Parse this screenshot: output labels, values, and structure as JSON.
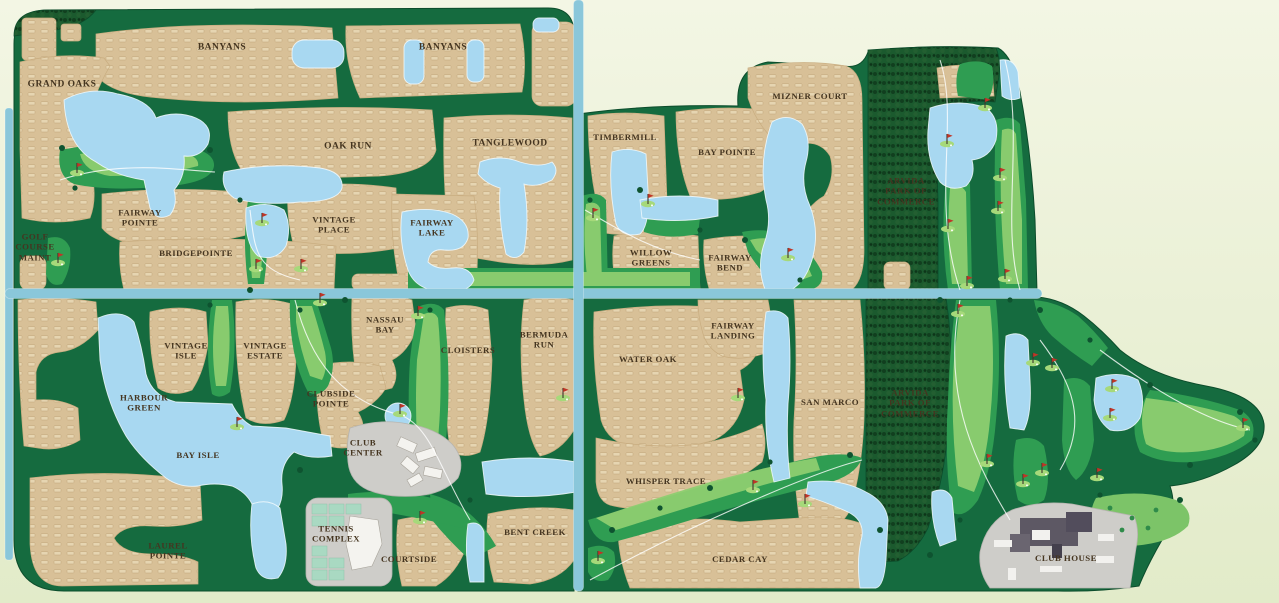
{
  "map": {
    "type": "residential-golf-community-site-map",
    "colors": {
      "background_top": "#f3f6e4",
      "background_bottom": "#e2ebc9",
      "land_green": "#156b3f",
      "forest_green": "#1b5a2e",
      "residential_tan": "#d8c097",
      "house_mark": "#e9d9b6",
      "lake_blue": "#a8d8f1",
      "road_teal": "#8ac7da",
      "fairway_green": "#2f9d52",
      "fairway_light": "#8dce70",
      "civic_gray": "#cecdc9",
      "building_dark": "#5d5864",
      "flag_red": "#c03527",
      "label_brown": "#453520"
    }
  },
  "labels": [
    {
      "id": "banyans-west",
      "text": "BANYANS",
      "x": 222,
      "y": 48,
      "size": 9.5
    },
    {
      "id": "banyans-east",
      "text": "BANYANS",
      "x": 443,
      "y": 48,
      "size": 9.5
    },
    {
      "id": "grand-oaks",
      "text": "GRAND OAKS",
      "x": 62,
      "y": 85,
      "size": 9.5
    },
    {
      "id": "oak-run",
      "text": "OAK RUN",
      "x": 348,
      "y": 147,
      "size": 9.5
    },
    {
      "id": "tanglewood",
      "text": "TANGLEWOOD",
      "x": 510,
      "y": 144,
      "size": 9.5
    },
    {
      "id": "fairway-pointe",
      "text": "FAIRWAY\nPOINTE",
      "x": 140,
      "y": 218
    },
    {
      "id": "vintage-place",
      "text": "VINTAGE\nPLACE",
      "x": 334,
      "y": 225
    },
    {
      "id": "fairway-lake",
      "text": "FAIRWAY\nLAKE",
      "x": 432,
      "y": 228
    },
    {
      "id": "bridgepointe",
      "text": "BRIDGEPOINTE",
      "x": 196,
      "y": 253
    },
    {
      "id": "golf-course-maint",
      "text": "GOLF\nCOURSE\nMAINT",
      "x": 35,
      "y": 247
    },
    {
      "id": "timbermill",
      "text": "TIMBERMILL",
      "x": 625,
      "y": 137
    },
    {
      "id": "bay-pointe",
      "text": "BAY POINTE",
      "x": 727,
      "y": 152
    },
    {
      "id": "mizner-court",
      "text": "MIZNER COURT",
      "x": 810,
      "y": 96
    },
    {
      "id": "willow-greens",
      "text": "WILLOW\nGREENS",
      "x": 651,
      "y": 258
    },
    {
      "id": "fairway-bend",
      "text": "FAIRWAY\nBEND",
      "x": 730,
      "y": 263
    },
    {
      "id": "arvida-park-north",
      "text": "ARVIDA\nPARK OF\nCOMMERCE",
      "x": 906,
      "y": 191
    },
    {
      "id": "vintage-isle",
      "text": "VINTAGE\nISLE",
      "x": 186,
      "y": 351
    },
    {
      "id": "vintage-estate",
      "text": "VINTAGE\nESTATE",
      "x": 265,
      "y": 351
    },
    {
      "id": "nassau-bay",
      "text": "NASSAU\nBAY",
      "x": 385,
      "y": 325
    },
    {
      "id": "harbour-green",
      "text": "HARBOUR\nGREEN",
      "x": 144,
      "y": 403
    },
    {
      "id": "clubside-pointe",
      "text": "CLUBSIDE\nPOINTE",
      "x": 331,
      "y": 399
    },
    {
      "id": "bay-isle",
      "text": "BAY ISLE",
      "x": 198,
      "y": 455
    },
    {
      "id": "club-center",
      "text": "CLUB\nCENTER",
      "x": 363,
      "y": 448
    },
    {
      "id": "cloisters",
      "text": "CLOISTERS",
      "x": 468,
      "y": 350
    },
    {
      "id": "bermuda-run",
      "text": "BERMUDA\nRUN",
      "x": 544,
      "y": 340
    },
    {
      "id": "water-oak",
      "text": "WATER OAK",
      "x": 648,
      "y": 359
    },
    {
      "id": "fairway-landing",
      "text": "FAIRWAY\nLANDING",
      "x": 733,
      "y": 331
    },
    {
      "id": "san-marco",
      "text": "SAN MARCO",
      "x": 830,
      "y": 402
    },
    {
      "id": "arvida-park-south",
      "text": "ARVIDA\nPARK OF\nCOMMERCE",
      "x": 910,
      "y": 403
    },
    {
      "id": "whisper-trace",
      "text": "WHISPER TRACE",
      "x": 666,
      "y": 481
    },
    {
      "id": "bent-creek",
      "text": "BENT CREEK",
      "x": 535,
      "y": 532
    },
    {
      "id": "cedar-cay",
      "text": "CEDAR CAY",
      "x": 740,
      "y": 559
    },
    {
      "id": "laurel-pointe",
      "text": "LAUREL\nPOINTE",
      "x": 168,
      "y": 551
    },
    {
      "id": "tennis-complex",
      "text": "TENNIS\nCOMPLEX",
      "x": 336,
      "y": 534
    },
    {
      "id": "courtside",
      "text": "COURTSIDE",
      "x": 409,
      "y": 559
    },
    {
      "id": "club-house",
      "text": "CLUB HOUSE",
      "x": 1066,
      "y": 558
    }
  ],
  "flags": [
    [
      77,
      172
    ],
    [
      58,
      262
    ],
    [
      262,
      222
    ],
    [
      256,
      268
    ],
    [
      301,
      268
    ],
    [
      593,
      217
    ],
    [
      648,
      203
    ],
    [
      788,
      257
    ],
    [
      985,
      107
    ],
    [
      947,
      143
    ],
    [
      1000,
      177
    ],
    [
      998,
      210
    ],
    [
      948,
      228
    ],
    [
      1005,
      278
    ],
    [
      967,
      285
    ],
    [
      320,
      302
    ],
    [
      418,
      315
    ],
    [
      400,
      413
    ],
    [
      237,
      426
    ],
    [
      420,
      520
    ],
    [
      563,
      397
    ],
    [
      738,
      397
    ],
    [
      753,
      489
    ],
    [
      805,
      503
    ],
    [
      598,
      560
    ],
    [
      958,
      313
    ],
    [
      1033,
      362
    ],
    [
      1052,
      367
    ],
    [
      1112,
      388
    ],
    [
      1110,
      417
    ],
    [
      1243,
      427
    ],
    [
      987,
      463
    ],
    [
      1042,
      472
    ],
    [
      1023,
      483
    ],
    [
      1097,
      477
    ]
  ]
}
